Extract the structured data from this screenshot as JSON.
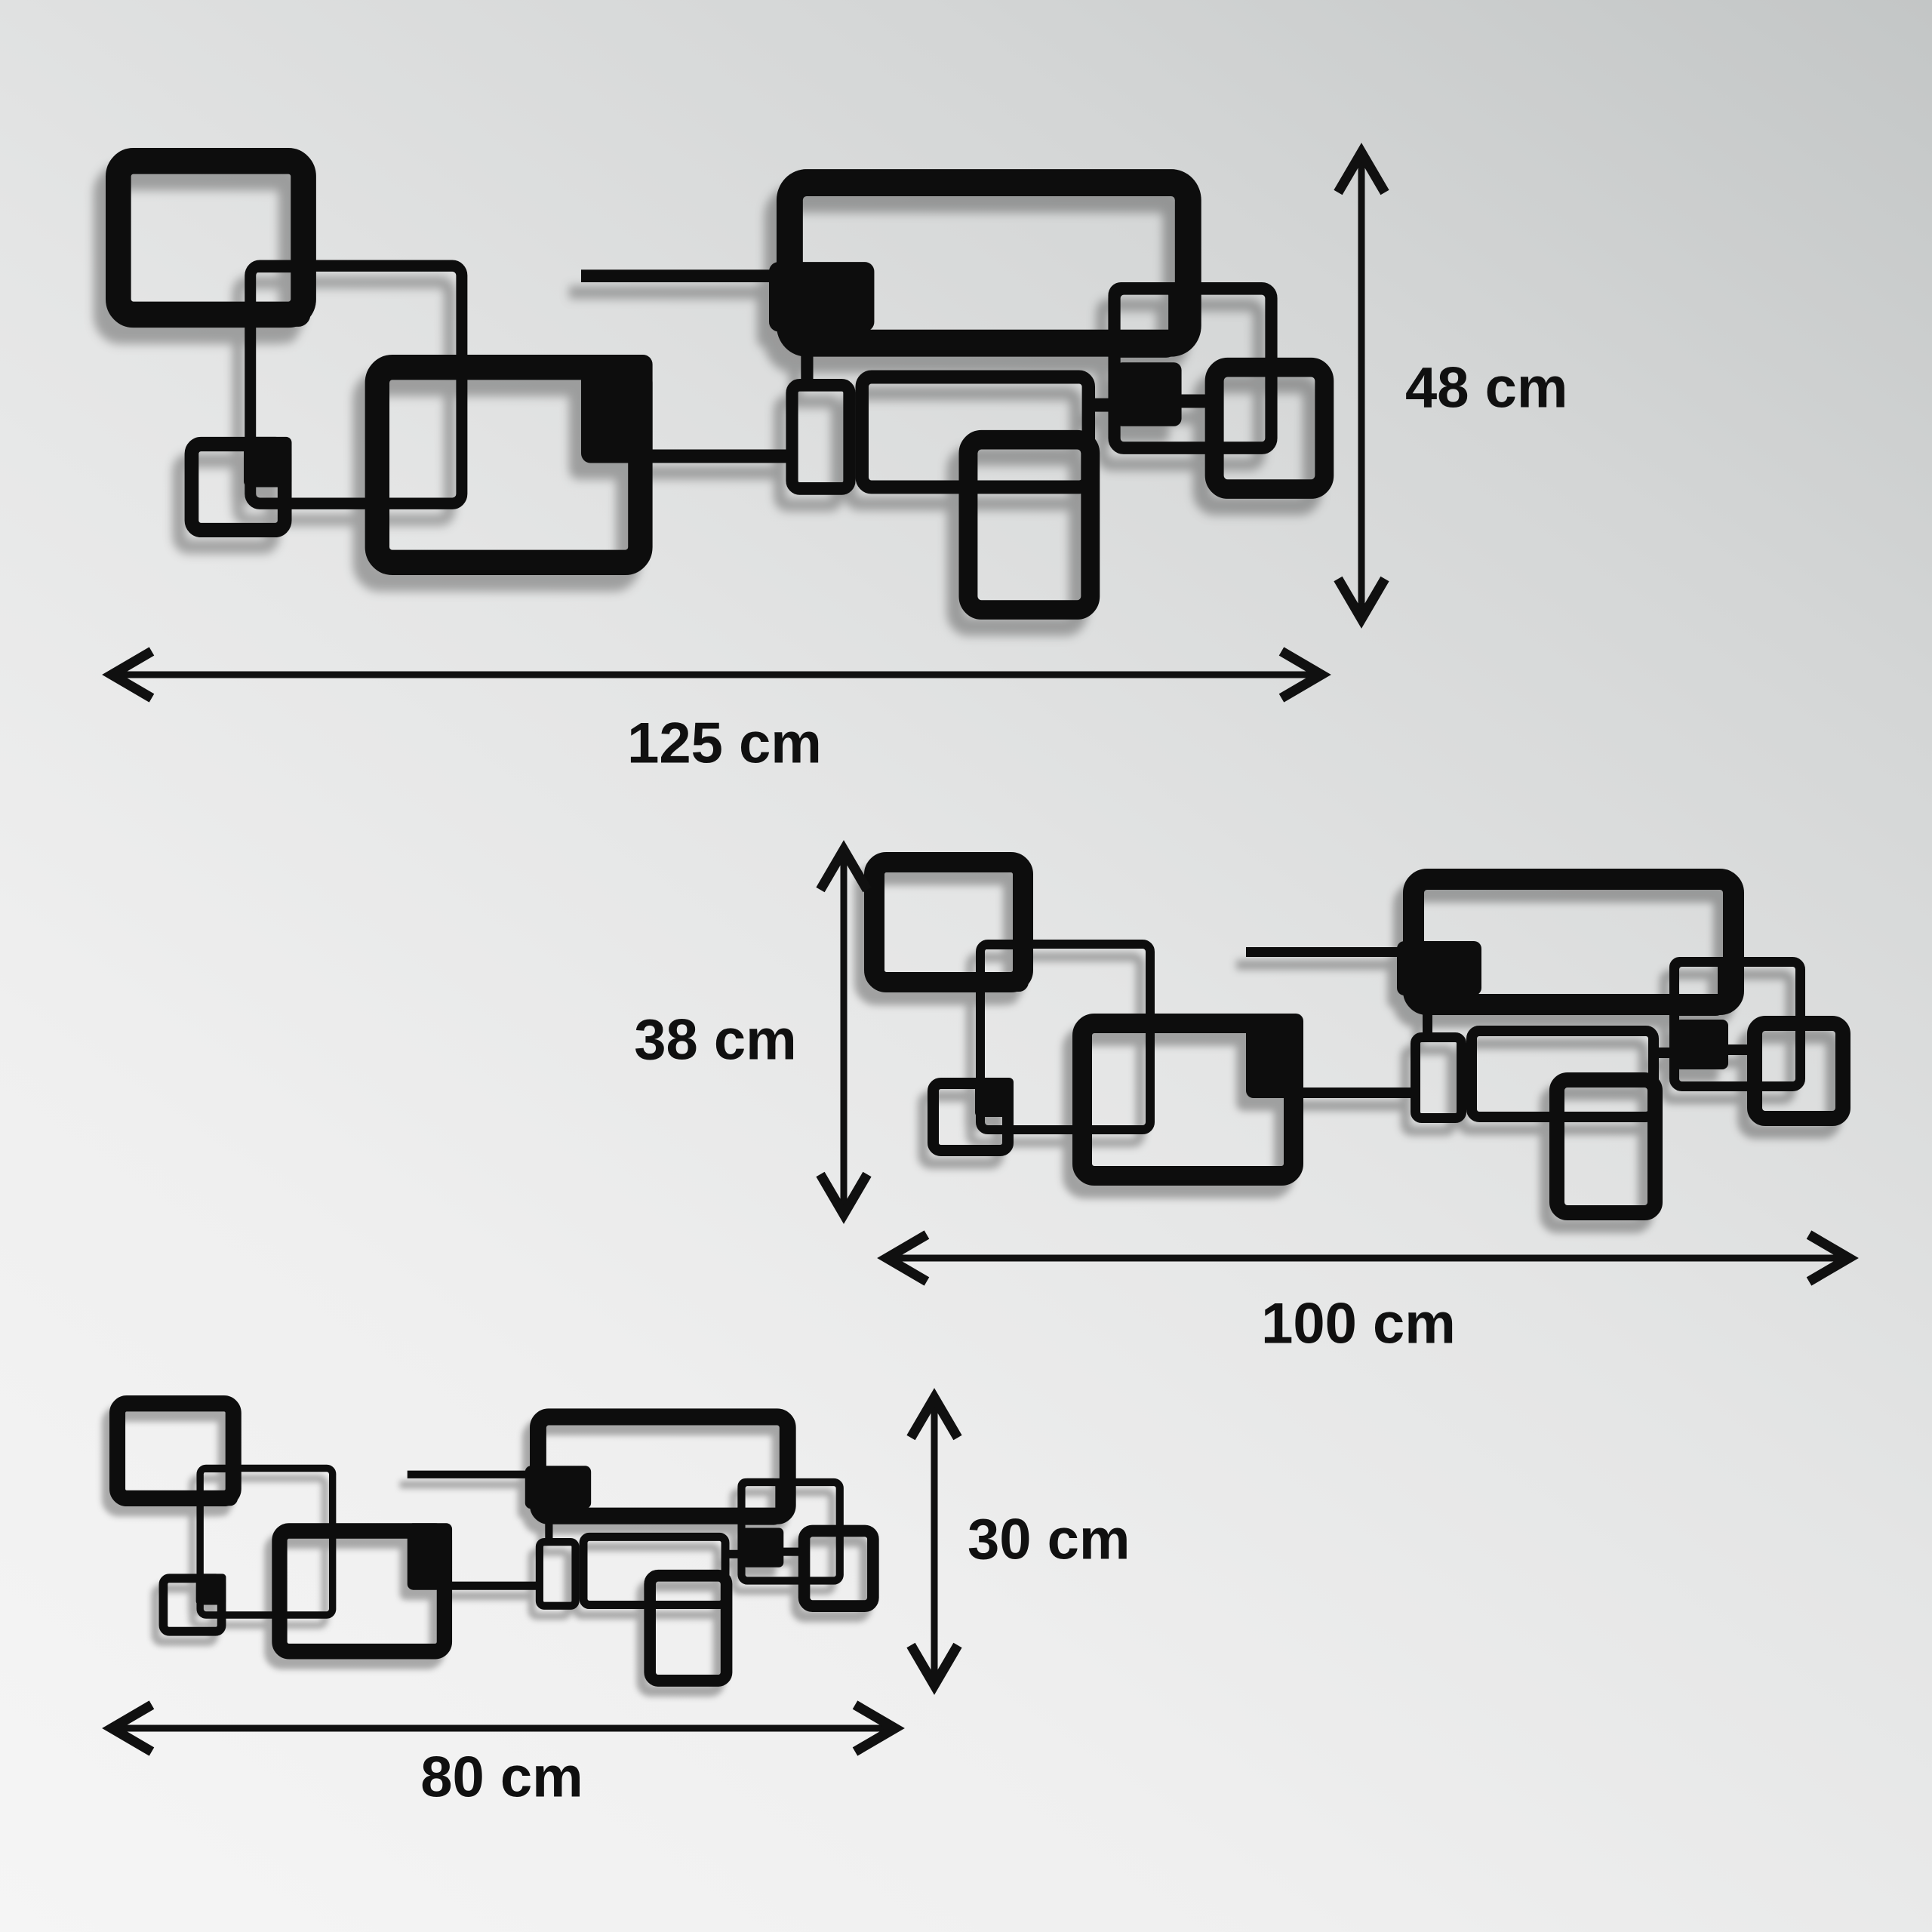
{
  "title": "Metal wall art size diagram",
  "product": {
    "name": "interlocking-squares-metal-wall-art",
    "art_color": "#0a0a0a",
    "shadow_color": "rgba(0,0,0,0.30)"
  },
  "background": {
    "top_right": "#c3c6c6",
    "bottom_left": "#f5f5f5"
  },
  "sizes": [
    {
      "name": "large",
      "width": "125 cm",
      "height": "48 cm"
    },
    {
      "name": "medium",
      "width": "100 cm",
      "height": "38 cm"
    },
    {
      "name": "small",
      "width": "80 cm",
      "height": "30 cm"
    }
  ]
}
